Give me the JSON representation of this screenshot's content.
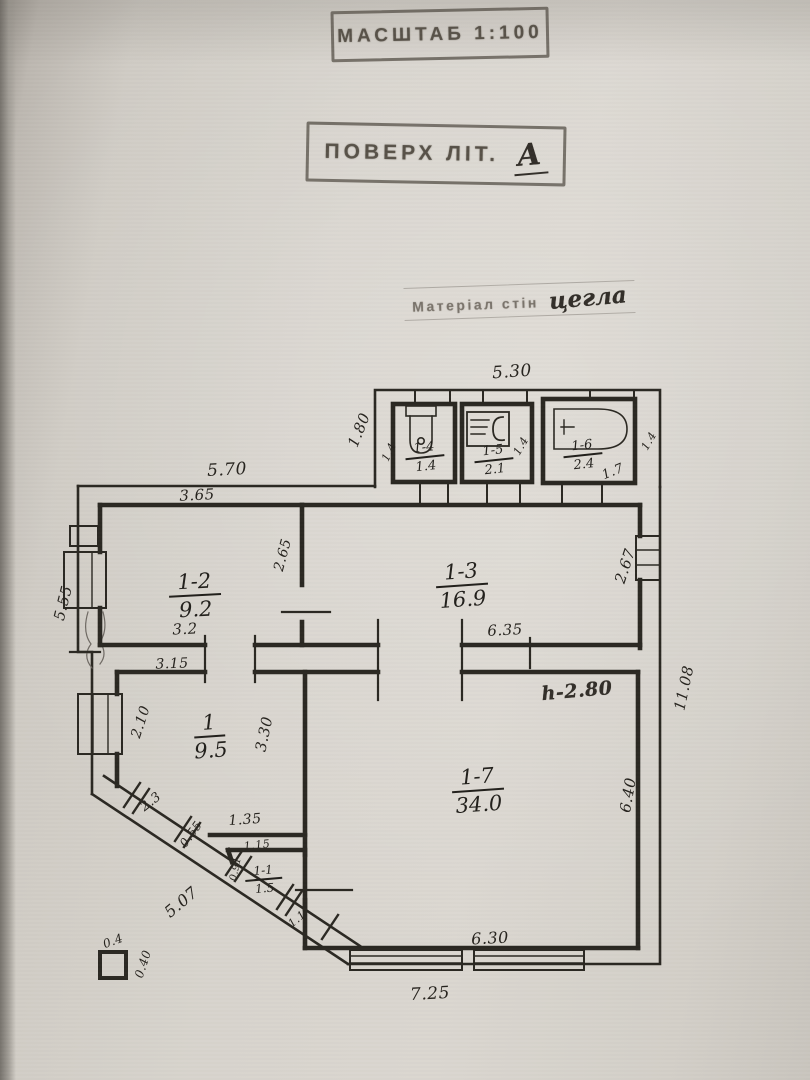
{
  "stamps": {
    "scale": "МАСШТАБ 1:100",
    "floor_label": "ПОВЕРХ ЛІТ.",
    "floor_value": "А",
    "material_label": "Матеріал стін",
    "material_value": "цегла"
  },
  "rooms": [
    {
      "id": "1-2",
      "area": "9.2"
    },
    {
      "id": "1-3",
      "area": "16.9"
    },
    {
      "id": "1",
      "area": "9.5"
    },
    {
      "id": "1-7",
      "area": "34.0"
    },
    {
      "id": "1-4",
      "area": "1.4"
    },
    {
      "id": "1-5",
      "area": "2.1"
    },
    {
      "id": "1-6",
      "area": "2.4"
    },
    {
      "id": "1-1",
      "area": "1.5"
    }
  ],
  "height_note": "h-2.80",
  "dims": {
    "wing_top": "5.30",
    "wing_left": "1.80",
    "top": "5.70",
    "left": "5.55",
    "right": "11.08",
    "bottom": "7.25",
    "r12_top": "3.65",
    "r12_right": "2.65",
    "r12_bottom": "3.2",
    "r13_bottom": "6.35",
    "r13_right": "2.67",
    "r1_top": "3.15",
    "r1_left": "2.10",
    "r1_right": "3.30",
    "r1_bottom": "1.35",
    "r17_right": "6.40",
    "r17_bottom": "6.30",
    "r14_side": "1.4",
    "r15_side": "1.4",
    "r16_side": "1.4",
    "r16_width": "1.7",
    "r11_top": "1.15",
    "r11_left": "0.91",
    "diag_1": "2.3",
    "diag_2": "0.55",
    "diag_3": "5.07",
    "diag_4": "1.1"
  },
  "legend": {
    "width": "0.4",
    "height": "0.40"
  }
}
